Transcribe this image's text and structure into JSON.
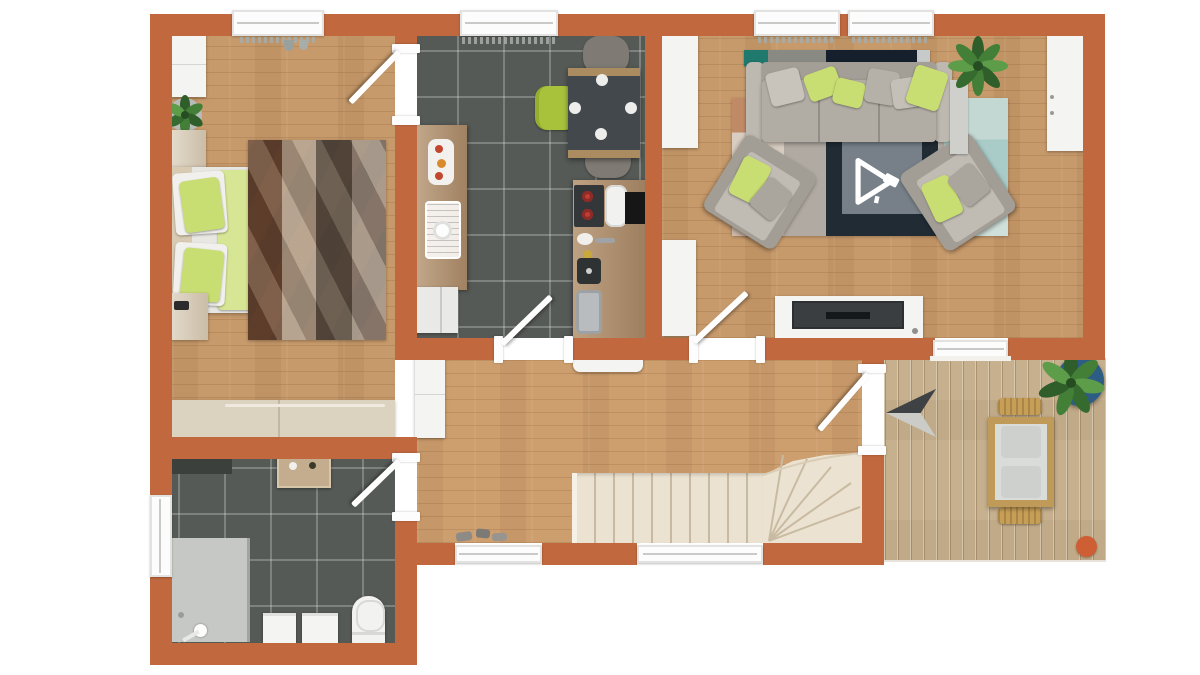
{
  "meta": {
    "kind": "3d-floor-plan-top-view-render",
    "no_visible_text": true,
    "view": "top-down single storey apartment"
  },
  "palette": {
    "background": "#ffffff",
    "wall": "#c1683f",
    "wood_floor": "#c79a6b",
    "tile_floor": "#565a56",
    "deck": "#c6b08e",
    "stairs": "#ebe2d1",
    "accent_lime": "#c9de72",
    "lime_dark": "#a9c23c",
    "sofa_gray": "#b2ada4",
    "sofa_dark": "#8f8a82",
    "rug_base": "#b1aaa2",
    "rug_navy": "#202b34",
    "rug_inner_gray": "#778089",
    "rug_orange": "#c9825a",
    "rug_blue": "#aaccc8",
    "counter_wood": "#b2906c",
    "table_top": "#43484c",
    "teal": "#1f7a6d",
    "tv_dark": "#3a3e41",
    "flue_black": "#161616",
    "burner_red": "#c03d35",
    "plant_green": "#447f38",
    "plant_green_light": "#5d9c49",
    "pot_blue": "#2d5d85",
    "orange_dot": "#ce5e33",
    "steel": "#b8bcbe",
    "shower_gray": "#c6c8c5",
    "white_furniture": "#f4f4f3"
  },
  "rooms": [
    {
      "name": "bedroom",
      "floor": "wood",
      "items": [
        "wardrobe",
        "potted-plant",
        "nightstand-top",
        "double-bed",
        "lime-duvet",
        "pillows",
        "diamond-pattern-rug",
        "nightstand-bottom",
        "dresser",
        "window",
        "radiator",
        "door"
      ]
    },
    {
      "name": "kitchen-dining",
      "floor": "dark-tile",
      "items": [
        "kitchen-counter",
        "dish-rack",
        "plates-of-food",
        "cooktop",
        "flue",
        "prep-sink",
        "steel-sink",
        "dining-table",
        "table-plates",
        "gray-chair-x2",
        "lime-chair",
        "window",
        "radiator",
        "door"
      ]
    },
    {
      "name": "living-room",
      "floor": "wood",
      "items": [
        "console-shelf",
        "sofa",
        "lime-and-gray-cushions",
        "armchair-x2",
        "area-rug",
        "rug-center-panel",
        "rotate-cursor-graphic",
        "tv-stand",
        "tv",
        "tall-cabinet-x2",
        "sideboard",
        "side-table",
        "house-plant",
        "window-x2",
        "radiator-x2",
        "door"
      ]
    },
    {
      "name": "hallway",
      "floor": "wood",
      "items": [
        "hall-wardrobe",
        "white-bench",
        "shoes",
        "l-shaped-staircase",
        "window-x2"
      ]
    },
    {
      "name": "bathroom",
      "floor": "dark-tile",
      "items": [
        "dark-mat",
        "wash-table",
        "shower",
        "vanity-cabinet-x2",
        "toilet",
        "radiator",
        "side-window",
        "door"
      ]
    },
    {
      "name": "terrace",
      "floor": "deck-planks",
      "items": [
        "north-arrow-marker",
        "outdoor-dining-table",
        "outdoor-chair-x2",
        "planter-blue-pot",
        "orange-stool",
        "terrace-door",
        "terrace-window"
      ]
    }
  ],
  "icons": [
    "north-arrow-icon",
    "rotate-cursor-icon"
  ]
}
